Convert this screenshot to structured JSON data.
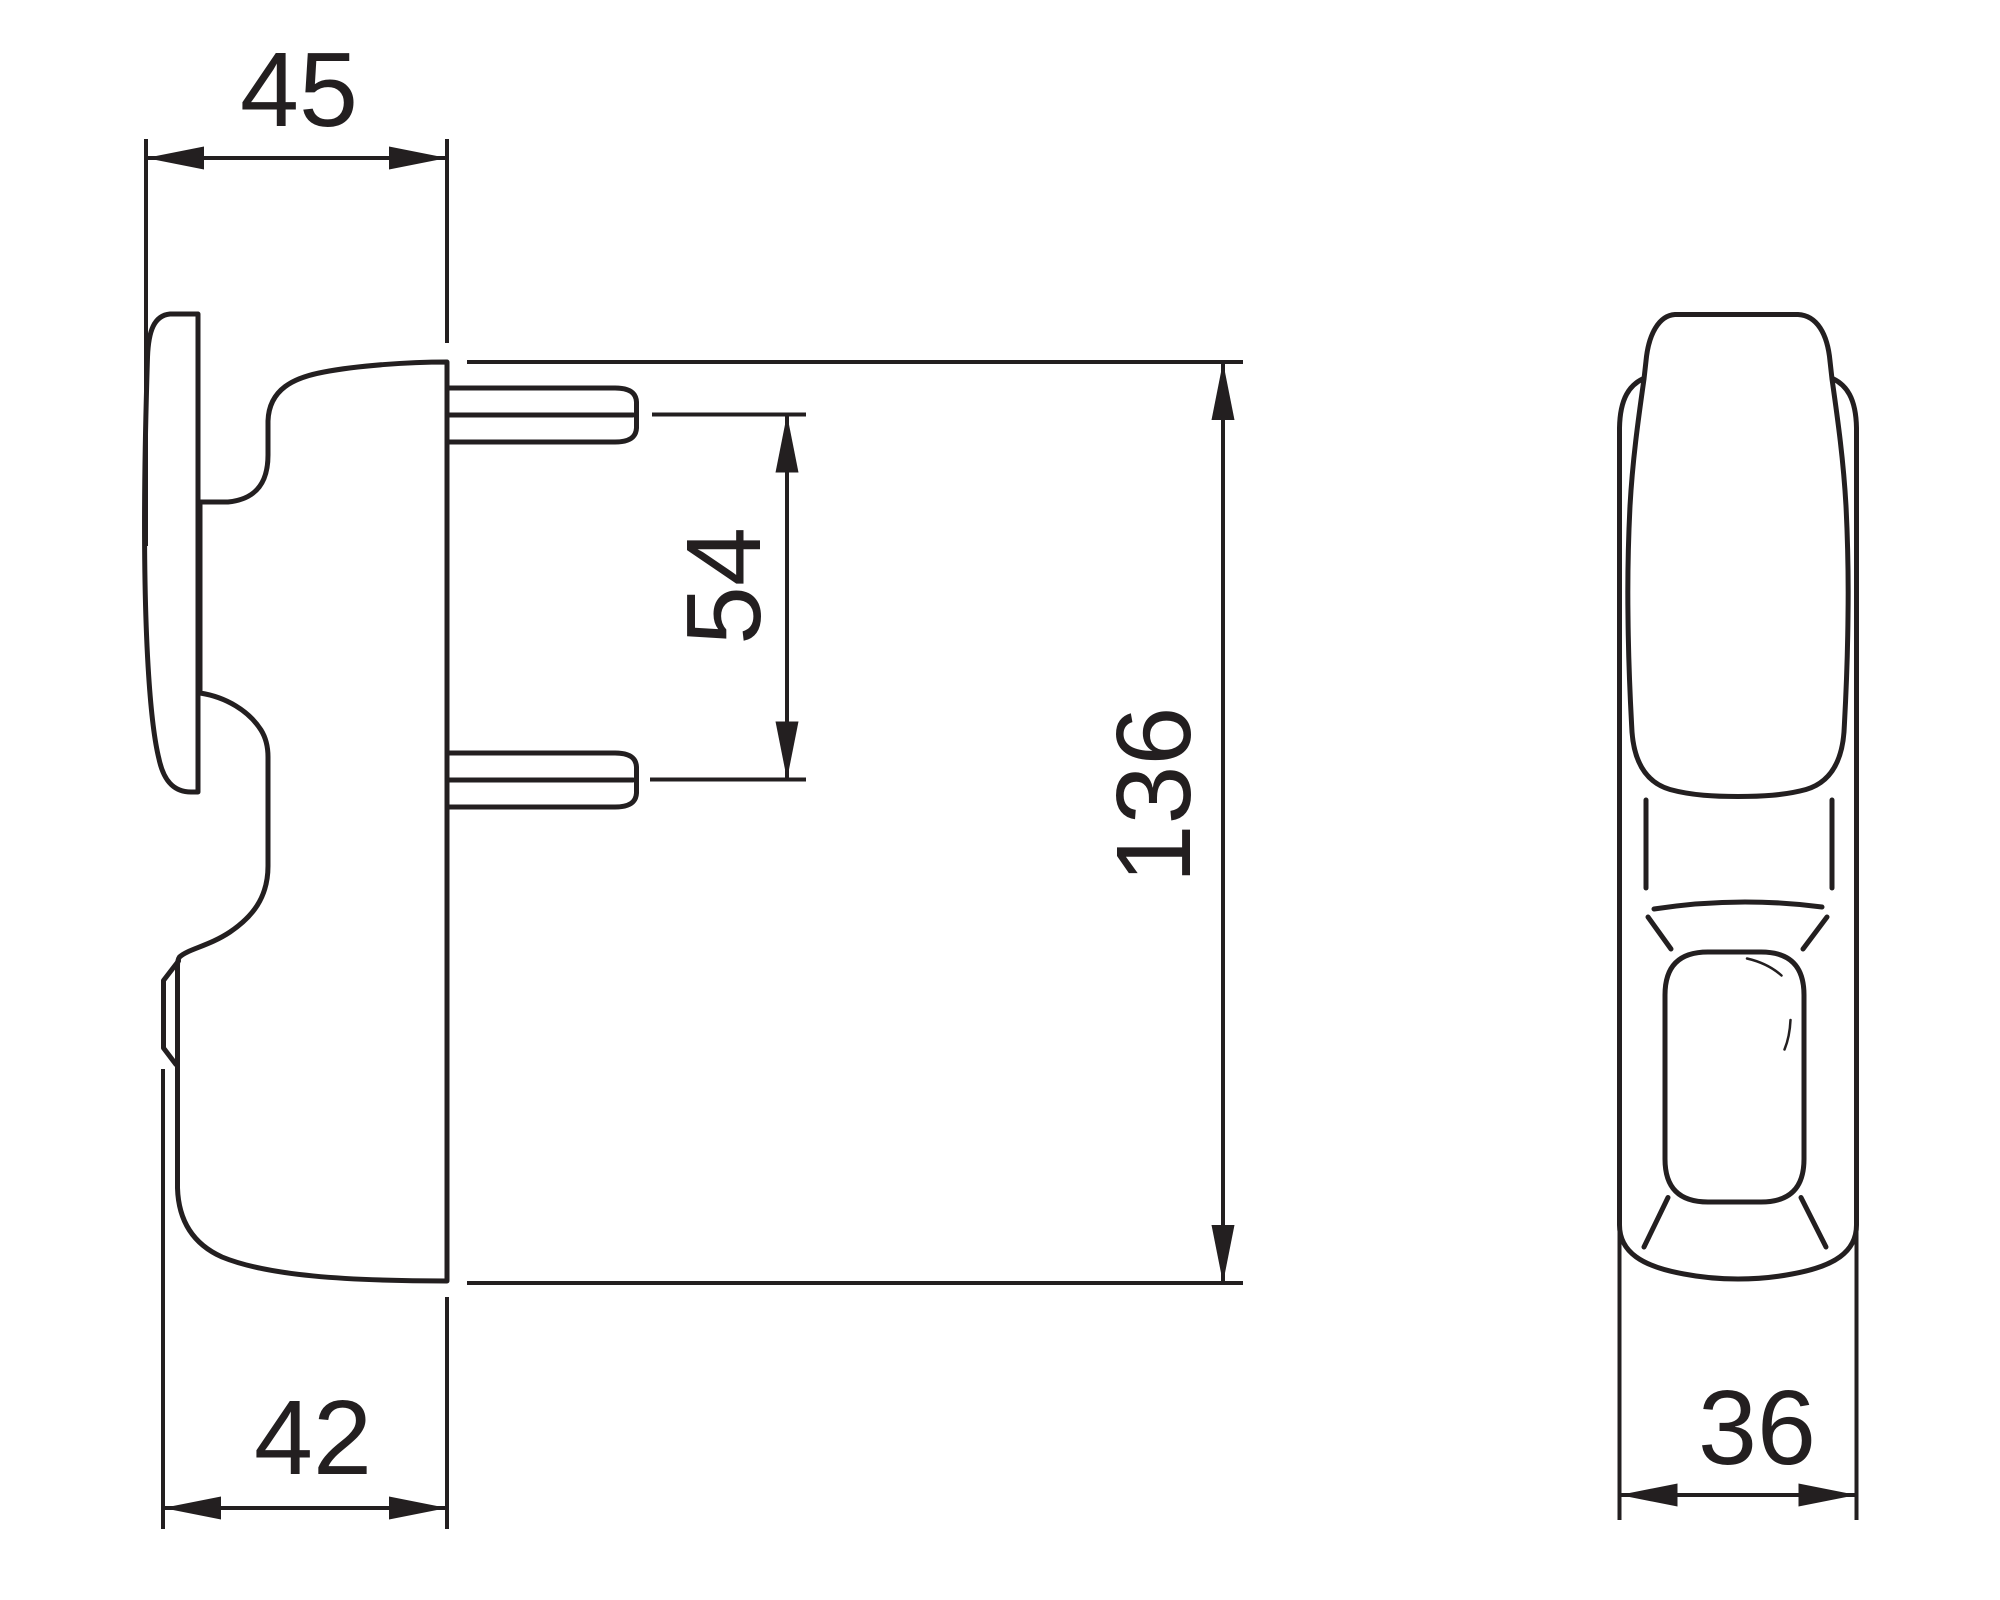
{
  "page": {
    "background": "#ffffff",
    "line_color": "#231f20"
  },
  "drawing": {
    "type": "technical-dimension-drawing",
    "views": [
      {
        "id": "side-view",
        "description": "handle side profile with escutcheon plate and two fixing pins"
      },
      {
        "id": "front-view",
        "description": "handle front profile with backplate and thumb recess"
      }
    ],
    "dimensions": [
      {
        "id": "top-depth",
        "label": "45"
      },
      {
        "id": "pin-spacing",
        "label": "54"
      },
      {
        "id": "overall-height",
        "label": "136"
      },
      {
        "id": "bottom-depth",
        "label": "42"
      },
      {
        "id": "overall-width",
        "label": "36"
      }
    ]
  }
}
